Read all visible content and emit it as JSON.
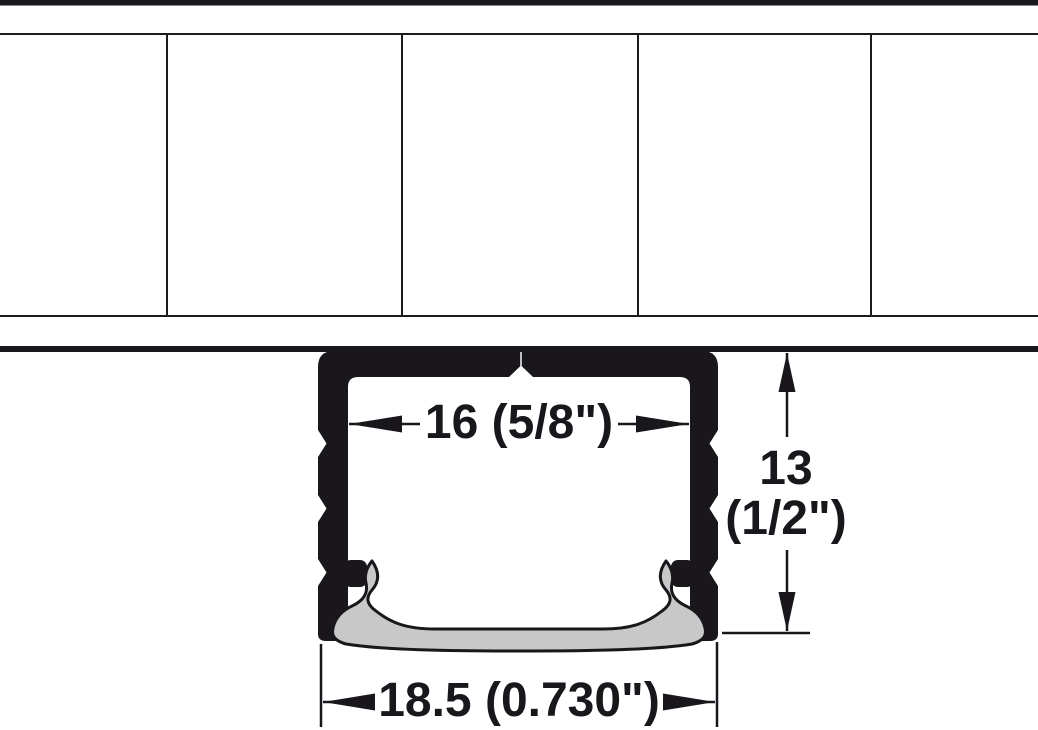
{
  "diagram": {
    "measurements": {
      "inner_width": {
        "label": "16 (5/8\")"
      },
      "height": {
        "value": "13",
        "unit": "(1/2\")"
      },
      "outer_width": {
        "label": "18.5 (0.730\")"
      }
    },
    "colors": {
      "profile_black": "#1a171c",
      "lens_gray": "#c7c8c7",
      "line_black": "#1d1b20",
      "background": "#ffffff"
    }
  }
}
